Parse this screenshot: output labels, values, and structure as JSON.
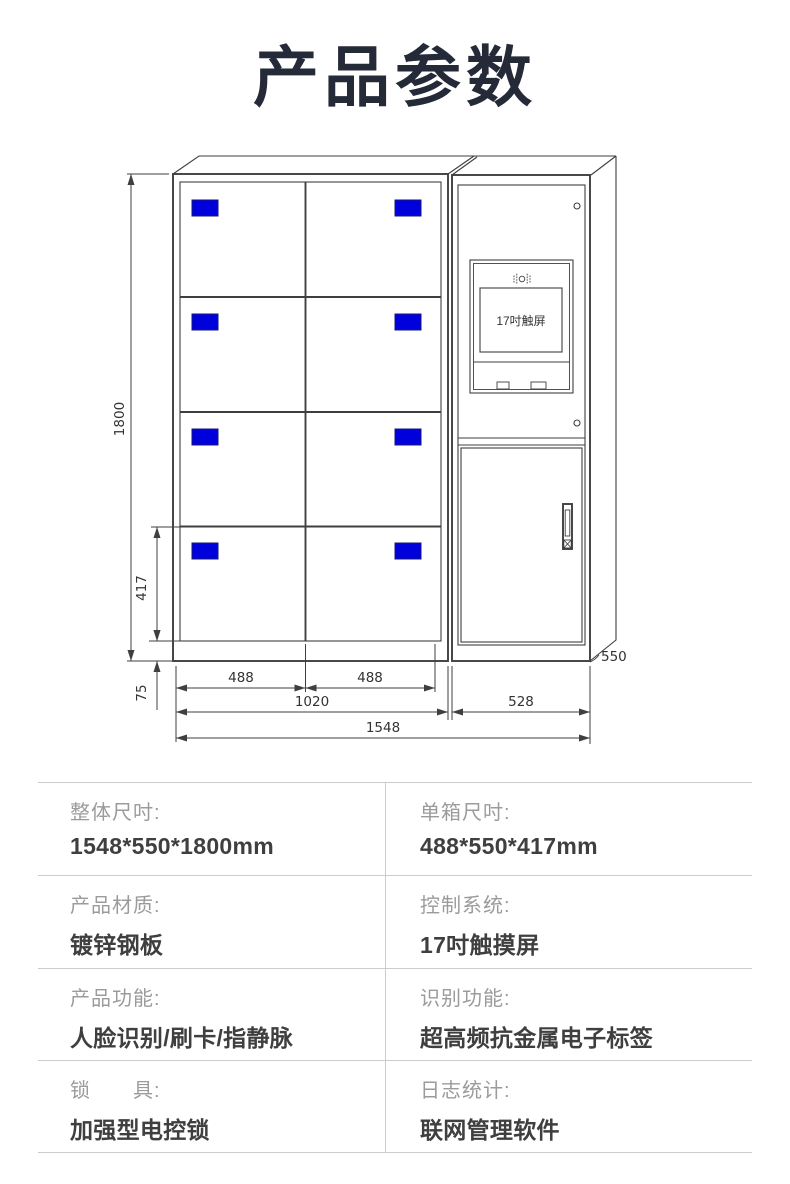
{
  "page": {
    "title": "产品参数"
  },
  "drawing": {
    "screen_label": "17吋触屏",
    "dims": {
      "height_total": "1800",
      "single_box_height": "417",
      "base_height": "75",
      "box_width_left": "488",
      "box_width_right": "488",
      "lockers_width": "1020",
      "control_width": "528",
      "total_width": "1548",
      "depth": "550"
    },
    "colors": {
      "door_label_blue": "#0000dd",
      "line": "#3f3f3f"
    }
  },
  "specs": {
    "rows": [
      {
        "left": {
          "label": "整体尺吋:",
          "value": "1548*550*1800mm"
        },
        "right": {
          "label": "单箱尺吋:",
          "value": "488*550*417mm"
        }
      },
      {
        "left": {
          "label": "产品材质:",
          "value": "镀锌钢板"
        },
        "right": {
          "label": "控制系统:",
          "value": "17吋触摸屏"
        }
      },
      {
        "left": {
          "label": "产品功能:",
          "value": "人脸识别/刷卡/指静脉"
        },
        "right": {
          "label": "识别功能:",
          "value": "超高频抗金属电子标签"
        }
      },
      {
        "left": {
          "label": "锁　　具:",
          "value": "加强型电控锁"
        },
        "right": {
          "label": "日志统计:",
          "value": "联网管理软件"
        }
      }
    ]
  }
}
